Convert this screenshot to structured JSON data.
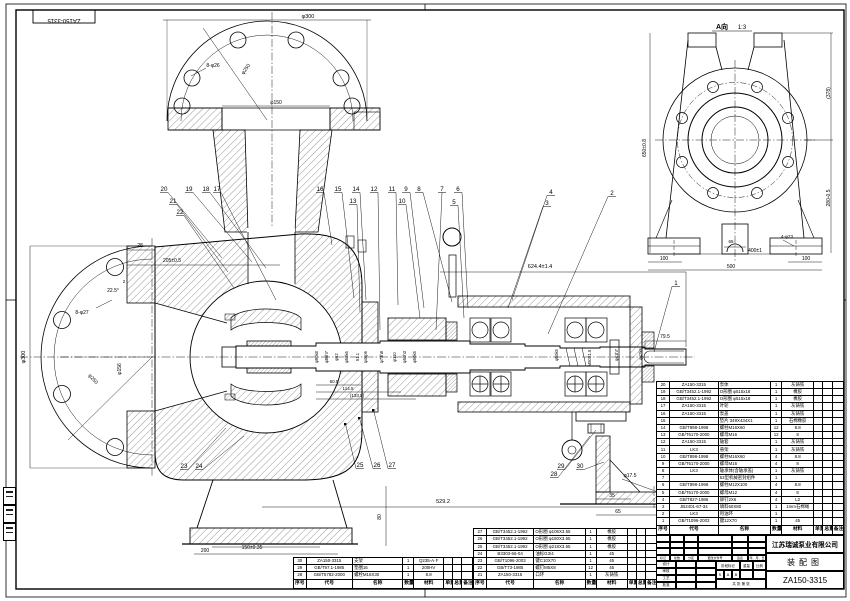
{
  "corner_label": "ZA150-3315",
  "view_a": {
    "title": "A向",
    "scale": "1:3"
  },
  "title_block": {
    "company": "江苏瑞诚泵业有限公司",
    "drawing_title": "装配图",
    "drawing_no": "ZA150-3315",
    "change_header": [
      "标记",
      "处数",
      "分区",
      "更改文件号",
      "签名",
      "年、月、日"
    ],
    "sig_rows": [
      "设计",
      "审核",
      "工艺",
      "批准"
    ],
    "stage_labels": [
      "阶段标记",
      "重量",
      "比例"
    ],
    "stage_marks": [
      "S",
      "A",
      "B"
    ],
    "sheet_note": "共 张 第 张"
  },
  "bom": {
    "headers": [
      "序号",
      "代号",
      "名称",
      "数量",
      "材料",
      "单重",
      "总重",
      "备注"
    ],
    "right_rows": [
      [
        "20",
        "ZA150-3315",
        "泵体",
        "1",
        "灰铸铁",
        "",
        "",
        ""
      ],
      [
        "19",
        "GB/T3452.1-1992",
        "O形圈 φ515x18",
        "1",
        "橡胶",
        "",
        "",
        ""
      ],
      [
        "18",
        "GB/T3452.1-1992",
        "O形圈 φ515x18",
        "1",
        "橡胶",
        "",
        "",
        ""
      ],
      [
        "17",
        "ZA150-3315",
        "叶轮",
        "1",
        "灰铸铁",
        "",
        "",
        ""
      ],
      [
        "16",
        "ZA150-3315",
        "泵盖",
        "1",
        "灰铸铁",
        "",
        "",
        ""
      ],
      [
        "15",
        "",
        "垫片 349X434X1",
        "1",
        "石棉橡胶",
        "",
        "",
        ""
      ],
      [
        "14",
        "GB/T898-1998",
        "螺柱M16X60",
        "12",
        "8.8",
        "",
        "",
        ""
      ],
      [
        "13",
        "GB/T6170-2000",
        "螺母M16",
        "12",
        "8",
        "",
        "",
        ""
      ],
      [
        "12",
        "ZA150-3315",
        "轴套",
        "1",
        "灰铸铁",
        "",
        "",
        ""
      ],
      [
        "11",
        "LK3",
        "悬架",
        "1",
        "灰铸铁",
        "",
        "",
        ""
      ],
      [
        "10",
        "GB/T898-1998",
        "螺柱M16X60",
        "4",
        "8.8",
        "",
        "",
        ""
      ],
      [
        "9",
        "GB/T6170-2000",
        "螺母M16",
        "4",
        "8",
        "",
        "",
        ""
      ],
      [
        "8",
        "LK3",
        "轴承体(含轴承盖)",
        "1",
        "灰铸铁",
        "",
        "",
        ""
      ],
      [
        "7",
        "",
        "53型机械密封组件",
        "1",
        "",
        "",
        "",
        ""
      ],
      [
        "6",
        "GB/T898-1998",
        "螺柱M12X100",
        "4",
        "8.8",
        "",
        "",
        ""
      ],
      [
        "5",
        "GB/T6170-2000",
        "螺母M12",
        "4",
        "8",
        "",
        "",
        ""
      ],
      [
        "4",
        "GB/T827-1986",
        "铆钉2X6",
        "4",
        "L2",
        "",
        "",
        ""
      ],
      [
        "3",
        "JB2401-67-34",
        "填料50X80",
        "1",
        "1mm石棉绳",
        "",
        "",
        ""
      ],
      [
        "2",
        "LK3",
        "甩油环",
        "1",
        "",
        "",
        "",
        ""
      ],
      [
        "1",
        "GB/T1096-2003",
        "键12X70",
        "1",
        "45",
        "",
        "",
        ""
      ]
    ],
    "mid_rows": [
      [
        "27",
        "GB/T3452.1-1992",
        "O形圈 φ106X3.55",
        "1",
        "橡胶",
        "",
        "",
        ""
      ],
      [
        "26",
        "GB/T3452.1-1992",
        "O形圈 φ160X3.55",
        "1",
        "橡胶",
        "",
        "",
        ""
      ],
      [
        "25",
        "GB/T3452.1-1992",
        "O形圈 φ218X3.55",
        "1",
        "橡胶",
        "",
        "",
        ""
      ],
      [
        "24",
        "B3303-66-04",
        "油标G3/4",
        "1",
        "45",
        "",
        "",
        ""
      ],
      [
        "23",
        "GB/T1096-2003",
        "键C10X70",
        "1",
        "45",
        "",
        "",
        ""
      ],
      [
        "22",
        "GB/T73-1985",
        "螺钉M5X8",
        "12",
        "45",
        "",
        "",
        ""
      ],
      [
        "21",
        "ZA150-3315",
        "口环",
        "1",
        "灰铸铁",
        "",
        "",
        ""
      ]
    ],
    "left_rows": [
      [
        "30",
        "ZA150-3315",
        "支架",
        "1",
        "Q235-A·F",
        "",
        "",
        ""
      ],
      [
        "29",
        "GB/T97.1-1985",
        "垫圈16",
        "1",
        "200HV",
        "",
        "",
        ""
      ],
      [
        "28",
        "GB/T5782-2000",
        "螺栓M16X30",
        "1",
        "8.8",
        "",
        "",
        ""
      ]
    ]
  },
  "annotations": [
    {
      "t": "ZA150-3315",
      "x": 64,
      "y": 19,
      "r": 180,
      "s": 6
    },
    {
      "t": "φ300",
      "x": 308,
      "y": 18,
      "s": 5.5
    },
    {
      "t": "8-φ26",
      "x": 213,
      "y": 67,
      "s": 5
    },
    {
      "t": "φ250",
      "x": 247,
      "y": 70,
      "r": -55,
      "s": 5
    },
    {
      "t": "φ150",
      "x": 276,
      "y": 104,
      "s": 5
    },
    {
      "t": "φ300",
      "x": 25,
      "y": 357,
      "r": -90,
      "s": 5.5
    },
    {
      "t": "8-φ27",
      "x": 82,
      "y": 314,
      "s": 5
    },
    {
      "t": "φ250",
      "x": 92,
      "y": 380,
      "r": 47,
      "s": 5
    },
    {
      "t": "φ156",
      "x": 121,
      "y": 369,
      "r": -90,
      "s": 5
    },
    {
      "t": "22.5°",
      "x": 113,
      "y": 292,
      "s": 5
    },
    {
      "t": "28",
      "x": 140,
      "y": 247,
      "s": 5
    },
    {
      "t": "2",
      "x": 124,
      "y": 283,
      "s": 4.5
    },
    {
      "t": "205±0.5",
      "x": 172,
      "y": 262,
      "s": 5
    },
    {
      "t": "624.4±1.4",
      "x": 540,
      "y": 268,
      "s": 5.5
    },
    {
      "t": "529.2",
      "x": 443,
      "y": 503,
      "s": 5.5
    },
    {
      "t": "80",
      "x": 381,
      "y": 517,
      "r": -90,
      "s": 5
    },
    {
      "t": "200",
      "x": 205,
      "y": 552,
      "s": 5
    },
    {
      "t": "150±0.35",
      "x": 252,
      "y": 549,
      "s": 5
    },
    {
      "t": "79.5",
      "x": 665,
      "y": 338,
      "s": 5
    },
    {
      "t": "φ17.5",
      "x": 630,
      "y": 477,
      "s": 5
    },
    {
      "t": "35",
      "x": 612,
      "y": 497,
      "s": 5
    },
    {
      "t": "65",
      "x": 618,
      "y": 513,
      "s": 5
    },
    {
      "t": "60.5",
      "x": 334,
      "y": 383,
      "s": 4.5
    },
    {
      "t": "114.5",
      "x": 348,
      "y": 390,
      "s": 4.5
    },
    {
      "t": "(133.5)",
      "x": 357,
      "y": 397,
      "s": 4.5
    },
    {
      "t": "φ90k8",
      "x": 318,
      "y": 357,
      "r": -90,
      "s": 4.2
    },
    {
      "t": "φ86h7",
      "x": 328,
      "y": 357,
      "r": -90,
      "s": 4.2
    },
    {
      "t": "φ62",
      "x": 338,
      "y": 357,
      "r": -90,
      "s": 4.2
    },
    {
      "t": "φ58k6",
      "x": 348,
      "y": 357,
      "r": -90,
      "s": 4.2
    },
    {
      "t": "51.1",
      "x": 359,
      "y": 357,
      "r": -90,
      "s": 4.2
    },
    {
      "t": "φ46p6",
      "x": 367,
      "y": 357,
      "r": -90,
      "s": 4.2
    },
    {
      "t": "φ73h8",
      "x": 383,
      "y": 357,
      "r": -90,
      "s": 4.2
    },
    {
      "t": "φ110",
      "x": 396,
      "y": 357,
      "r": -90,
      "s": 4.2
    },
    {
      "t": "φ50h3",
      "x": 406,
      "y": 357,
      "r": -90,
      "s": 4.2
    },
    {
      "t": "φ50k5",
      "x": 416,
      "y": 357,
      "r": -90,
      "s": 4.2
    },
    {
      "t": "φ50k5",
      "x": 558,
      "y": 355,
      "r": -90,
      "s": 4.2
    },
    {
      "t": "M50X1.5",
      "x": 591,
      "y": 358,
      "r": -90,
      "s": 4.2
    },
    {
      "t": "φ41h7",
      "x": 618,
      "y": 355,
      "r": -90,
      "s": 4.2
    },
    {
      "t": "φ42k6",
      "x": 642,
      "y": 354,
      "r": -90,
      "s": 4.2
    },
    {
      "t": "650±0.8",
      "x": 646,
      "y": 148,
      "r": -90,
      "s": 5
    },
    {
      "t": "(378)",
      "x": 830,
      "y": 93,
      "r": -90,
      "s": 5
    },
    {
      "t": "280-0.5",
      "x": 830,
      "y": 198,
      "r": -90,
      "s": 5
    },
    {
      "t": "400±1",
      "x": 755,
      "y": 252,
      "s": 5
    },
    {
      "t": "500",
      "x": 731,
      "y": 268,
      "s": 5
    },
    {
      "t": "100",
      "x": 664,
      "y": 260,
      "s": 5
    },
    {
      "t": "100",
      "x": 806,
      "y": 260,
      "s": 5
    },
    {
      "t": "65",
      "x": 731,
      "y": 243,
      "s": 4.5
    },
    {
      "t": "4-φ23",
      "x": 787,
      "y": 238,
      "s": 4.5
    }
  ],
  "balloons": [
    {
      "n": "20",
      "x": 164,
      "y": 191,
      "tx": 222,
      "ty": 258
    },
    {
      "n": "21",
      "x": 173,
      "y": 203,
      "tx": 228,
      "ty": 272
    },
    {
      "n": "22",
      "x": 180,
      "y": 214,
      "tx": 234,
      "ty": 288
    },
    {
      "n": "19",
      "x": 189,
      "y": 191,
      "tx": 252,
      "ty": 262
    },
    {
      "n": "18",
      "x": 206,
      "y": 191,
      "tx": 266,
      "ty": 268
    },
    {
      "n": "17",
      "x": 217,
      "y": 191,
      "tx": 276,
      "ty": 300
    },
    {
      "n": "16",
      "x": 320,
      "y": 191,
      "tx": 332,
      "ty": 245
    },
    {
      "n": "15",
      "x": 338,
      "y": 191,
      "tx": 354,
      "ty": 298
    },
    {
      "n": "13",
      "x": 353,
      "y": 203,
      "tx": 360,
      "ty": 312
    },
    {
      "n": "14",
      "x": 356,
      "y": 191,
      "tx": 366,
      "ty": 300
    },
    {
      "n": "12",
      "x": 374,
      "y": 191,
      "tx": 380,
      "ty": 330
    },
    {
      "n": "11",
      "x": 392,
      "y": 191,
      "tx": 398,
      "ty": 305
    },
    {
      "n": "9",
      "x": 406,
      "y": 191,
      "tx": 424,
      "ty": 308
    },
    {
      "n": "10",
      "x": 402,
      "y": 203,
      "tx": 420,
      "ty": 318
    },
    {
      "n": "8",
      "x": 419,
      "y": 191,
      "tx": 452,
      "ty": 302
    },
    {
      "n": "7",
      "x": 442,
      "y": 191,
      "tx": 436,
      "ty": 330
    },
    {
      "n": "6",
      "x": 458,
      "y": 191,
      "tx": 468,
      "ty": 308
    },
    {
      "n": "5",
      "x": 454,
      "y": 204,
      "tx": 464,
      "ty": 318
    },
    {
      "n": "4",
      "x": 551,
      "y": 194,
      "tx": 512,
      "ty": 300
    },
    {
      "n": "3",
      "x": 547,
      "y": 205,
      "tx": 508,
      "ty": 308
    },
    {
      "n": "2",
      "x": 612,
      "y": 195,
      "tx": 548,
      "ty": 334
    },
    {
      "n": "1",
      "x": 676,
      "y": 285,
      "tx": 654,
      "ty": 352
    },
    {
      "n": "23",
      "x": 184,
      "y": 468,
      "tx": 226,
      "ty": 428
    },
    {
      "n": "24",
      "x": 199,
      "y": 468,
      "tx": 244,
      "ty": 436
    },
    {
      "n": "25",
      "x": 360,
      "y": 467,
      "tx": 346,
      "ty": 426
    },
    {
      "n": "26",
      "x": 377,
      "y": 467,
      "tx": 360,
      "ty": 420
    },
    {
      "n": "27",
      "x": 392,
      "y": 467,
      "tx": 374,
      "ty": 412
    },
    {
      "n": "28",
      "x": 554,
      "y": 476,
      "tx": 590,
      "ty": 436
    },
    {
      "n": "29",
      "x": 561,
      "y": 468,
      "tx": 596,
      "ty": 430
    },
    {
      "n": "30",
      "x": 580,
      "y": 468,
      "tx": 604,
      "ty": 462
    }
  ]
}
